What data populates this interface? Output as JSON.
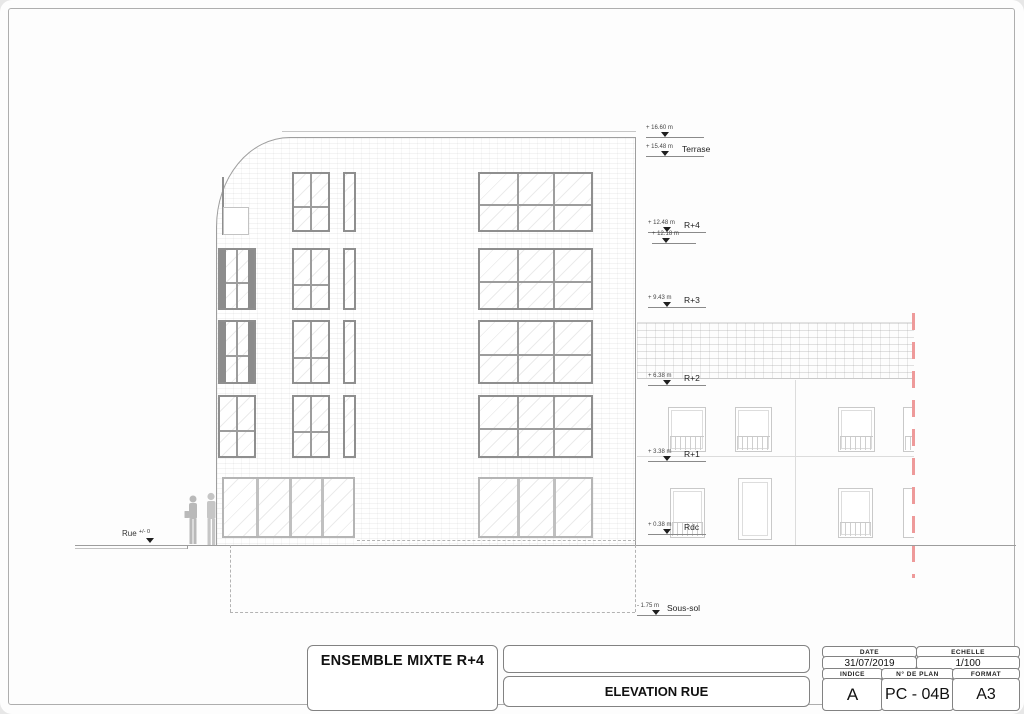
{
  "sheet": {
    "background": "#e7e7e7",
    "paper": "#fdfdfd",
    "frame_color": "#aeaeae",
    "boundary_line_color": "#ee9a9a"
  },
  "elevation": {
    "street_label": "Rue",
    "street_level_value": "+/- 0",
    "levels": [
      {
        "label": "",
        "value": "+ 16.60 m"
      },
      {
        "label": "Terrase",
        "value": "+ 15.48 m"
      },
      {
        "label": "R+4",
        "value": "+ 12.48 m"
      },
      {
        "label": "",
        "value": "+ 12.18 m"
      },
      {
        "label": "R+3",
        "value": "+ 9.43 m"
      },
      {
        "label": "R+2",
        "value": "+ 6.38 m"
      },
      {
        "label": "R+1",
        "value": "+ 3.38 m"
      },
      {
        "label": "Rdc",
        "value": "+ 0.38 m"
      },
      {
        "label": "Sous-sol",
        "value": "- 1.75 m"
      }
    ]
  },
  "title_block": {
    "project_title": "ENSEMBLE MIXTE R+4",
    "drawing_title": "ELEVATION RUE",
    "date_label": "DATE",
    "date_value": "31/07/2019",
    "scale_label": "ECHELLE",
    "scale_value": "1/100",
    "index_label": "INDICE",
    "index_value": "A",
    "plan_number_label": "N° DE PLAN",
    "plan_number_value": "PC - 04B",
    "format_label": "FORMAT",
    "format_value": "A3"
  }
}
